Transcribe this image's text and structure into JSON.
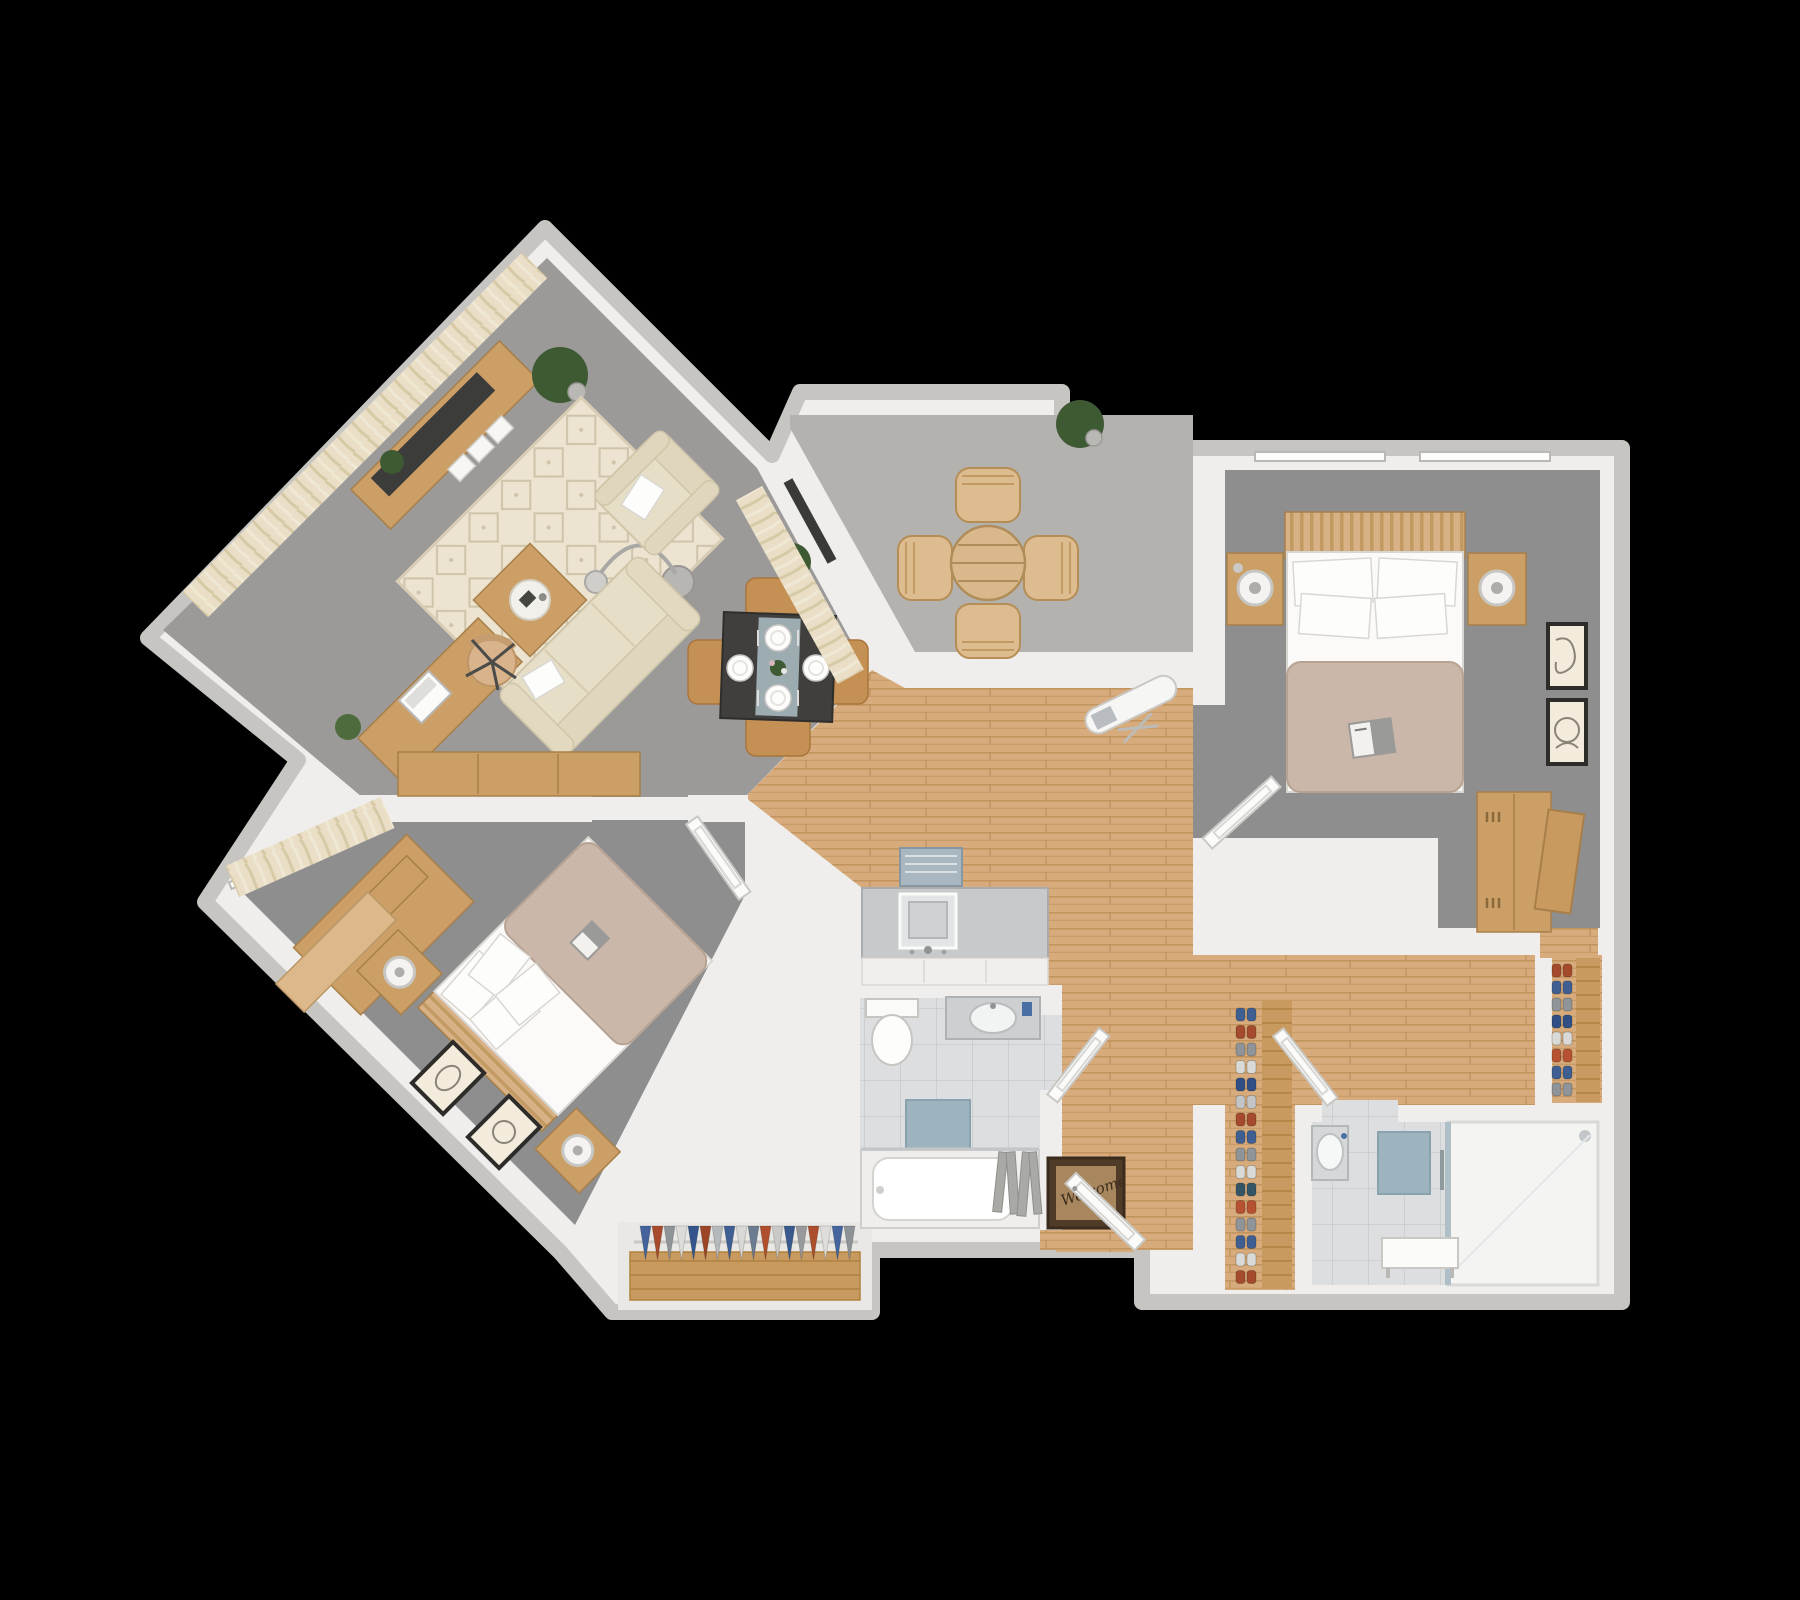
{
  "scene": {
    "type": "3d-floor-plan-top-down-render",
    "background": "#000000",
    "apartment": "two-bedroom apartment with angled left wing and balcony"
  },
  "palette": {
    "wall": "#efeeec",
    "wall-edge": "#c7c5c1",
    "carpet-living": "#9b9a99",
    "carpet-bed": "#8e8e8f",
    "balcony-floor": "#b4b2ae",
    "wood-floor": "#d7ab7c",
    "wood-line": "#c2955f",
    "furn-wood": "#cb9f66",
    "sofa": "#e7dec8",
    "rug": "#ece4d1",
    "tile": "#dcdedf",
    "tile-line": "#c8cacb",
    "mat-blue": "#9db4bf",
    "tv": "#3c3c3a",
    "plant": "#3e5a33",
    "table-dark": "#403f3d",
    "welcome-outer": "#4f3b28",
    "welcome-inner": "#a8875f"
  },
  "entry": {
    "welcome_mat_text": "Welcome"
  },
  "rooms": [
    {
      "name": "Living / Dining Room",
      "floor": "gray carpet",
      "furniture": [
        "tv-console with flat tv",
        "three-seat cream sofa",
        "cream armchair",
        "diamond pattern rug",
        "square wood coffee table with tray",
        "arc floor lamp",
        "desk with laptop",
        "desk chair",
        "dining table with 4 chairs and 4 place settings",
        "potted plants",
        "window curtains"
      ]
    },
    {
      "name": "Balcony",
      "floor": "gray outdoor carpet",
      "furniture": [
        "round slatted wood table",
        "4 outdoor chairs",
        "potted plant",
        "sliding door threshold"
      ]
    },
    {
      "name": "Bedroom 2 (right)",
      "floor": "gray carpet",
      "furniture": [
        "double bed with slat headboard and tan duvet",
        "4 white pillows",
        "open book on bed",
        "2 wood nightstands with round lamps",
        "tall wood wardrobe",
        "2 framed line-art prints",
        "ironing board near door",
        "windows"
      ]
    },
    {
      "name": "Bedroom 1 (lower-left wing)",
      "floor": "gray carpet",
      "furniture": [
        "double bed rotated 45deg with tan duvet",
        "2 wood nightstands with round lamps",
        "wood dresser",
        "wood bench",
        "2 framed line-art prints",
        "window curtains"
      ]
    },
    {
      "name": "Bathroom 1",
      "floor": "tile",
      "furniture": [
        "toilet",
        "vanity with sink",
        "bathtub with gray shower curtain",
        "blue bath mat"
      ]
    },
    {
      "name": "Bathroom 2",
      "floor": "tile + walk-in shower",
      "furniture": [
        "glass shower enclosure",
        "small sink",
        "bench",
        "blue bath mat"
      ]
    },
    {
      "name": "Kitchen / Hall",
      "floor": "wood planks",
      "furniture": [
        "gray counter with square sink and faucet",
        "patterned kitchen mat",
        "welcome mat",
        "front door"
      ]
    },
    {
      "name": "Closets",
      "floor": "wood",
      "furniture": [
        "hanging clothes rod",
        "two vertical shoe racks"
      ]
    }
  ],
  "closet_clothes_colors": [
    "#44639c",
    "#a84b2c",
    "#8f9498",
    "#dcdcda",
    "#33558c",
    "#9c4526",
    "#b6b9bc",
    "#3f5f93",
    "#d8d8d6",
    "#7d8setting"
  ],
  "clothes_colors": [
    "#44639c",
    "#a84b2c",
    "#8f9498",
    "#dcdcda",
    "#33558c",
    "#9c4526",
    "#b6b9bc",
    "#3f5f93",
    "#d8d8d6",
    "#6b7b90",
    "#b04f2e",
    "#c9c9c7",
    "#3a5a8e",
    "#98999c",
    "#aa4e2d",
    "#dedddb",
    "#46659e",
    "#8d9296"
  ],
  "shoe_colors_rack_a": [
    "#3f5f93",
    "#a54a2c",
    "#8f9498",
    "#d9d9d7",
    "#2f4f85",
    "#c2c4c6",
    "#a54a2c",
    "#3f5f93",
    "#8f9498",
    "#d9d9d7",
    "#356",
    "#b65232",
    "#8f9498",
    "#3f5f93",
    "#d9d9d7",
    "#a54a2c"
  ],
  "shoe_colors_rack_b": [
    "#a54a2c",
    "#3f5f93",
    "#8f9498",
    "#2f4f85",
    "#d9d9d7",
    "#b65232",
    "#3f5f93",
    "#8f9498"
  ]
}
